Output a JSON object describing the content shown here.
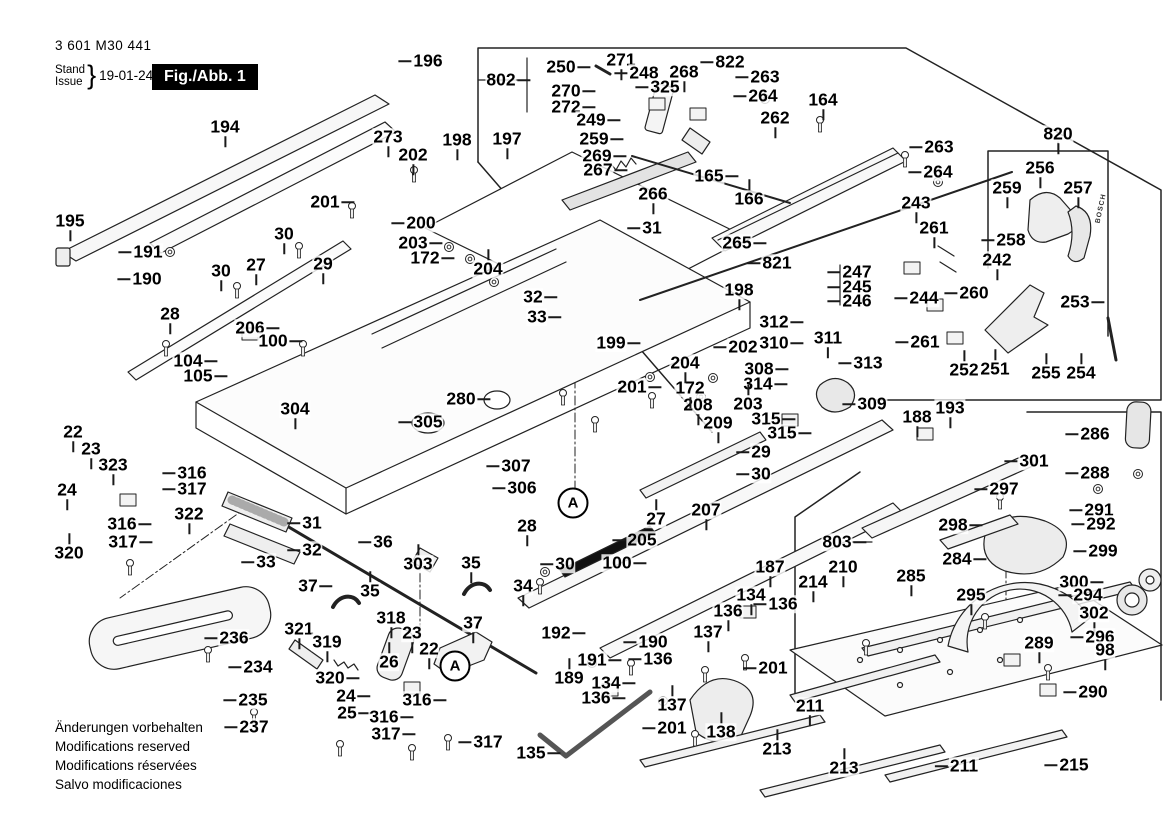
{
  "header": {
    "part_number": "3 601 M30 441",
    "stand_label": "Stand",
    "issue_label": "Issue",
    "brace": "}",
    "date": "19-01-24",
    "figure_label": "Fig./Abb. 1"
  },
  "footer": {
    "lines": [
      "Änderungen vorbehalten",
      "Modifications reserved",
      "Modifications réservées",
      "Salvo modificaciones"
    ]
  },
  "drawing": {
    "brand_text": "BOSCH",
    "line_color": "#222222",
    "detail_markers": [
      {
        "label": "A",
        "x": 573,
        "y": 503
      },
      {
        "label": "A",
        "x": 455,
        "y": 666
      }
    ]
  },
  "part_labels": [
    [
      "194",
      225,
      127,
      "d"
    ],
    [
      "195",
      70,
      221,
      "d"
    ],
    [
      "191",
      148,
      252,
      "l"
    ],
    [
      "190",
      147,
      279,
      "l"
    ],
    [
      "273",
      388,
      137,
      "d"
    ],
    [
      "196",
      428,
      61,
      "l"
    ],
    [
      "202",
      413,
      155,
      "d"
    ],
    [
      "198",
      457,
      140,
      "d"
    ],
    [
      "197",
      507,
      139,
      "d"
    ],
    [
      "201",
      325,
      202,
      "r"
    ],
    [
      "30",
      284,
      234,
      "d"
    ],
    [
      "27",
      256,
      265,
      "d"
    ],
    [
      "29",
      323,
      264,
      "d"
    ],
    [
      "30",
      221,
      271,
      "d"
    ],
    [
      "28",
      170,
      314,
      "d"
    ],
    [
      "206",
      250,
      328,
      "r"
    ],
    [
      "100",
      273,
      341,
      "r"
    ],
    [
      "104",
      188,
      361,
      "r"
    ],
    [
      "105",
      198,
      376,
      "r"
    ],
    [
      "200",
      421,
      223,
      "l"
    ],
    [
      "203",
      413,
      243,
      "r"
    ],
    [
      "172",
      425,
      258,
      "r"
    ],
    [
      "204",
      488,
      269,
      "u"
    ],
    [
      "802",
      501,
      80,
      "r"
    ],
    [
      "250",
      561,
      67,
      "r"
    ],
    [
      "271",
      621,
      60,
      "d"
    ],
    [
      "248",
      644,
      73,
      "l"
    ],
    [
      "268",
      684,
      72,
      "d"
    ],
    [
      "325",
      665,
      87,
      "l"
    ],
    [
      "270",
      566,
      91,
      "r"
    ],
    [
      "272",
      566,
      107,
      "r"
    ],
    [
      "249",
      591,
      120,
      "r"
    ],
    [
      "259",
      594,
      139,
      "r"
    ],
    [
      "269",
      597,
      156,
      "r"
    ],
    [
      "267",
      598,
      170,
      "r"
    ],
    [
      "266",
      653,
      194,
      "d"
    ],
    [
      "31",
      652,
      228,
      "l"
    ],
    [
      "822",
      730,
      62,
      "l"
    ],
    [
      "263",
      765,
      77,
      "l"
    ],
    [
      "264",
      763,
      96,
      "l"
    ],
    [
      "164",
      823,
      100,
      "d"
    ],
    [
      "262",
      775,
      118,
      "d"
    ],
    [
      "165",
      709,
      176,
      "r"
    ],
    [
      "166",
      749,
      199,
      "u"
    ],
    [
      "263",
      939,
      147,
      "l"
    ],
    [
      "264",
      938,
      172,
      "l"
    ],
    [
      "243",
      916,
      203,
      "d"
    ],
    [
      "261",
      934,
      228,
      "d"
    ],
    [
      "820",
      1058,
      134,
      "d"
    ],
    [
      "256",
      1040,
      168,
      "d"
    ],
    [
      "259",
      1007,
      188,
      "d"
    ],
    [
      "257",
      1078,
      188,
      "d"
    ],
    [
      "258",
      1011,
      240,
      "l"
    ],
    [
      "242",
      997,
      260,
      "d"
    ],
    [
      "260",
      974,
      293,
      "l"
    ],
    [
      "244",
      924,
      298,
      "l"
    ],
    [
      "253",
      1075,
      302,
      "r"
    ],
    [
      "261",
      925,
      342,
      "l"
    ],
    [
      "252",
      964,
      370,
      "u"
    ],
    [
      "251",
      995,
      369,
      "u"
    ],
    [
      "255",
      1046,
      373,
      "u"
    ],
    [
      "254",
      1081,
      373,
      "u"
    ],
    [
      "265",
      737,
      243,
      "r"
    ],
    [
      "821",
      777,
      263,
      "l"
    ],
    [
      "198",
      739,
      290,
      "d"
    ],
    [
      "202",
      743,
      347,
      "l"
    ],
    [
      "247",
      857,
      272,
      "l"
    ],
    [
      "245",
      857,
      287,
      "l"
    ],
    [
      "246",
      857,
      301,
      "l"
    ],
    [
      "312",
      774,
      322,
      "r"
    ],
    [
      "310",
      774,
      343,
      "r"
    ],
    [
      "311",
      828,
      338,
      "d"
    ],
    [
      "308",
      759,
      369,
      "r"
    ],
    [
      "314",
      758,
      384,
      "r"
    ],
    [
      "313",
      868,
      363,
      "l"
    ],
    [
      "203",
      748,
      404,
      "u"
    ],
    [
      "309",
      872,
      404,
      "l"
    ],
    [
      "315",
      766,
      419,
      "r"
    ],
    [
      "315",
      782,
      433,
      "r"
    ],
    [
      "209",
      718,
      423,
      "d"
    ],
    [
      "208",
      698,
      405,
      "d"
    ],
    [
      "172",
      690,
      388,
      "d"
    ],
    [
      "204",
      685,
      363,
      "d"
    ],
    [
      "201",
      632,
      387,
      "r"
    ],
    [
      "199",
      611,
      343,
      "r"
    ],
    [
      "32",
      533,
      297,
      "r"
    ],
    [
      "33",
      537,
      317,
      "r"
    ],
    [
      "280",
      461,
      399,
      "r"
    ],
    [
      "304",
      295,
      409,
      "d"
    ],
    [
      "305",
      428,
      422,
      "l"
    ],
    [
      "307",
      516,
      466,
      "l"
    ],
    [
      "306",
      522,
      488,
      "l"
    ],
    [
      "22",
      73,
      432,
      "d"
    ],
    [
      "23",
      91,
      449,
      "d"
    ],
    [
      "323",
      113,
      465,
      "d"
    ],
    [
      "24",
      67,
      490,
      "d"
    ],
    [
      "316",
      192,
      473,
      "l"
    ],
    [
      "317",
      192,
      489,
      "l"
    ],
    [
      "322",
      189,
      514,
      "d"
    ],
    [
      "316",
      122,
      524,
      "r"
    ],
    [
      "317",
      123,
      542,
      "r"
    ],
    [
      "320",
      69,
      553,
      "u"
    ],
    [
      "31",
      312,
      523,
      "l"
    ],
    [
      "32",
      312,
      550,
      "l"
    ],
    [
      "33",
      266,
      562,
      "l"
    ],
    [
      "36",
      383,
      542,
      "l"
    ],
    [
      "35",
      370,
      591,
      "u"
    ],
    [
      "303",
      418,
      564,
      "u"
    ],
    [
      "37",
      308,
      586,
      "r"
    ],
    [
      "35",
      471,
      563,
      "d"
    ],
    [
      "34",
      523,
      586,
      "d"
    ],
    [
      "28",
      527,
      526,
      "d"
    ],
    [
      "27",
      656,
      519,
      "u"
    ],
    [
      "205",
      642,
      540,
      "l"
    ],
    [
      "30",
      565,
      564,
      "l"
    ],
    [
      "100",
      617,
      563,
      "r"
    ],
    [
      "207",
      706,
      510,
      "d"
    ],
    [
      "29",
      761,
      452,
      "l"
    ],
    [
      "30",
      761,
      474,
      "l"
    ],
    [
      "187",
      770,
      567,
      "d"
    ],
    [
      "803",
      837,
      542,
      "r"
    ],
    [
      "210",
      843,
      567,
      "d"
    ],
    [
      "214",
      813,
      582,
      "d"
    ],
    [
      "188",
      917,
      417,
      "d"
    ],
    [
      "193",
      950,
      408,
      "d"
    ],
    [
      "301",
      1034,
      461,
      "l"
    ],
    [
      "286",
      1095,
      434,
      "l"
    ],
    [
      "288",
      1095,
      473,
      "l"
    ],
    [
      "297",
      1004,
      489,
      "l"
    ],
    [
      "298",
      953,
      525,
      "r"
    ],
    [
      "291",
      1099,
      510,
      "l"
    ],
    [
      "292",
      1101,
      524,
      "l"
    ],
    [
      "284",
      957,
      559,
      "r"
    ],
    [
      "299",
      1103,
      551,
      "l"
    ],
    [
      "300",
      1074,
      582,
      "r"
    ],
    [
      "294",
      1088,
      595,
      "l"
    ],
    [
      "285",
      911,
      576,
      "d"
    ],
    [
      "295",
      971,
      595,
      "d"
    ],
    [
      "302",
      1094,
      613,
      "d"
    ],
    [
      "289",
      1039,
      643,
      "d"
    ],
    [
      "296",
      1100,
      637,
      "l"
    ],
    [
      "98",
      1105,
      650,
      "d"
    ],
    [
      "290",
      1093,
      692,
      "l"
    ],
    [
      "211",
      964,
      766,
      "l"
    ],
    [
      "215",
      1074,
      765,
      "l"
    ],
    [
      "211",
      810,
      706,
      "d"
    ],
    [
      "213",
      777,
      749,
      "u"
    ],
    [
      "213",
      844,
      768,
      "u"
    ],
    [
      "192",
      556,
      633,
      "r"
    ],
    [
      "190",
      653,
      642,
      "l"
    ],
    [
      "191",
      592,
      660,
      "r"
    ],
    [
      "189",
      569,
      678,
      "u"
    ],
    [
      "134",
      606,
      683,
      "r"
    ],
    [
      "136",
      596,
      698,
      "r"
    ],
    [
      "136",
      658,
      659,
      "l"
    ],
    [
      "137",
      672,
      705,
      "u"
    ],
    [
      "201",
      672,
      728,
      "l"
    ],
    [
      "138",
      721,
      732,
      "u"
    ],
    [
      "135",
      531,
      753,
      "r"
    ],
    [
      "134",
      751,
      595,
      "d"
    ],
    [
      "136",
      728,
      611,
      "d"
    ],
    [
      "136",
      783,
      604,
      "l"
    ],
    [
      "137",
      708,
      632,
      "d"
    ],
    [
      "201",
      773,
      668,
      "l"
    ],
    [
      "236",
      234,
      638,
      "l"
    ],
    [
      "234",
      258,
      667,
      "l"
    ],
    [
      "235",
      253,
      700,
      "l"
    ],
    [
      "237",
      254,
      727,
      "l"
    ],
    [
      "321",
      299,
      629,
      "d"
    ],
    [
      "319",
      327,
      642,
      "d"
    ],
    [
      "318",
      391,
      618,
      "d"
    ],
    [
      "23",
      412,
      633,
      "d"
    ],
    [
      "22",
      429,
      649,
      "d"
    ],
    [
      "26",
      389,
      662,
      "u"
    ],
    [
      "320",
      330,
      678,
      "r"
    ],
    [
      "24",
      346,
      696,
      "r"
    ],
    [
      "25",
      347,
      713,
      "r"
    ],
    [
      "316",
      417,
      700,
      "r"
    ],
    [
      "316",
      384,
      717,
      "r"
    ],
    [
      "317",
      386,
      734,
      "r"
    ],
    [
      "317",
      488,
      742,
      "l"
    ],
    [
      "37",
      473,
      623,
      "d"
    ]
  ]
}
